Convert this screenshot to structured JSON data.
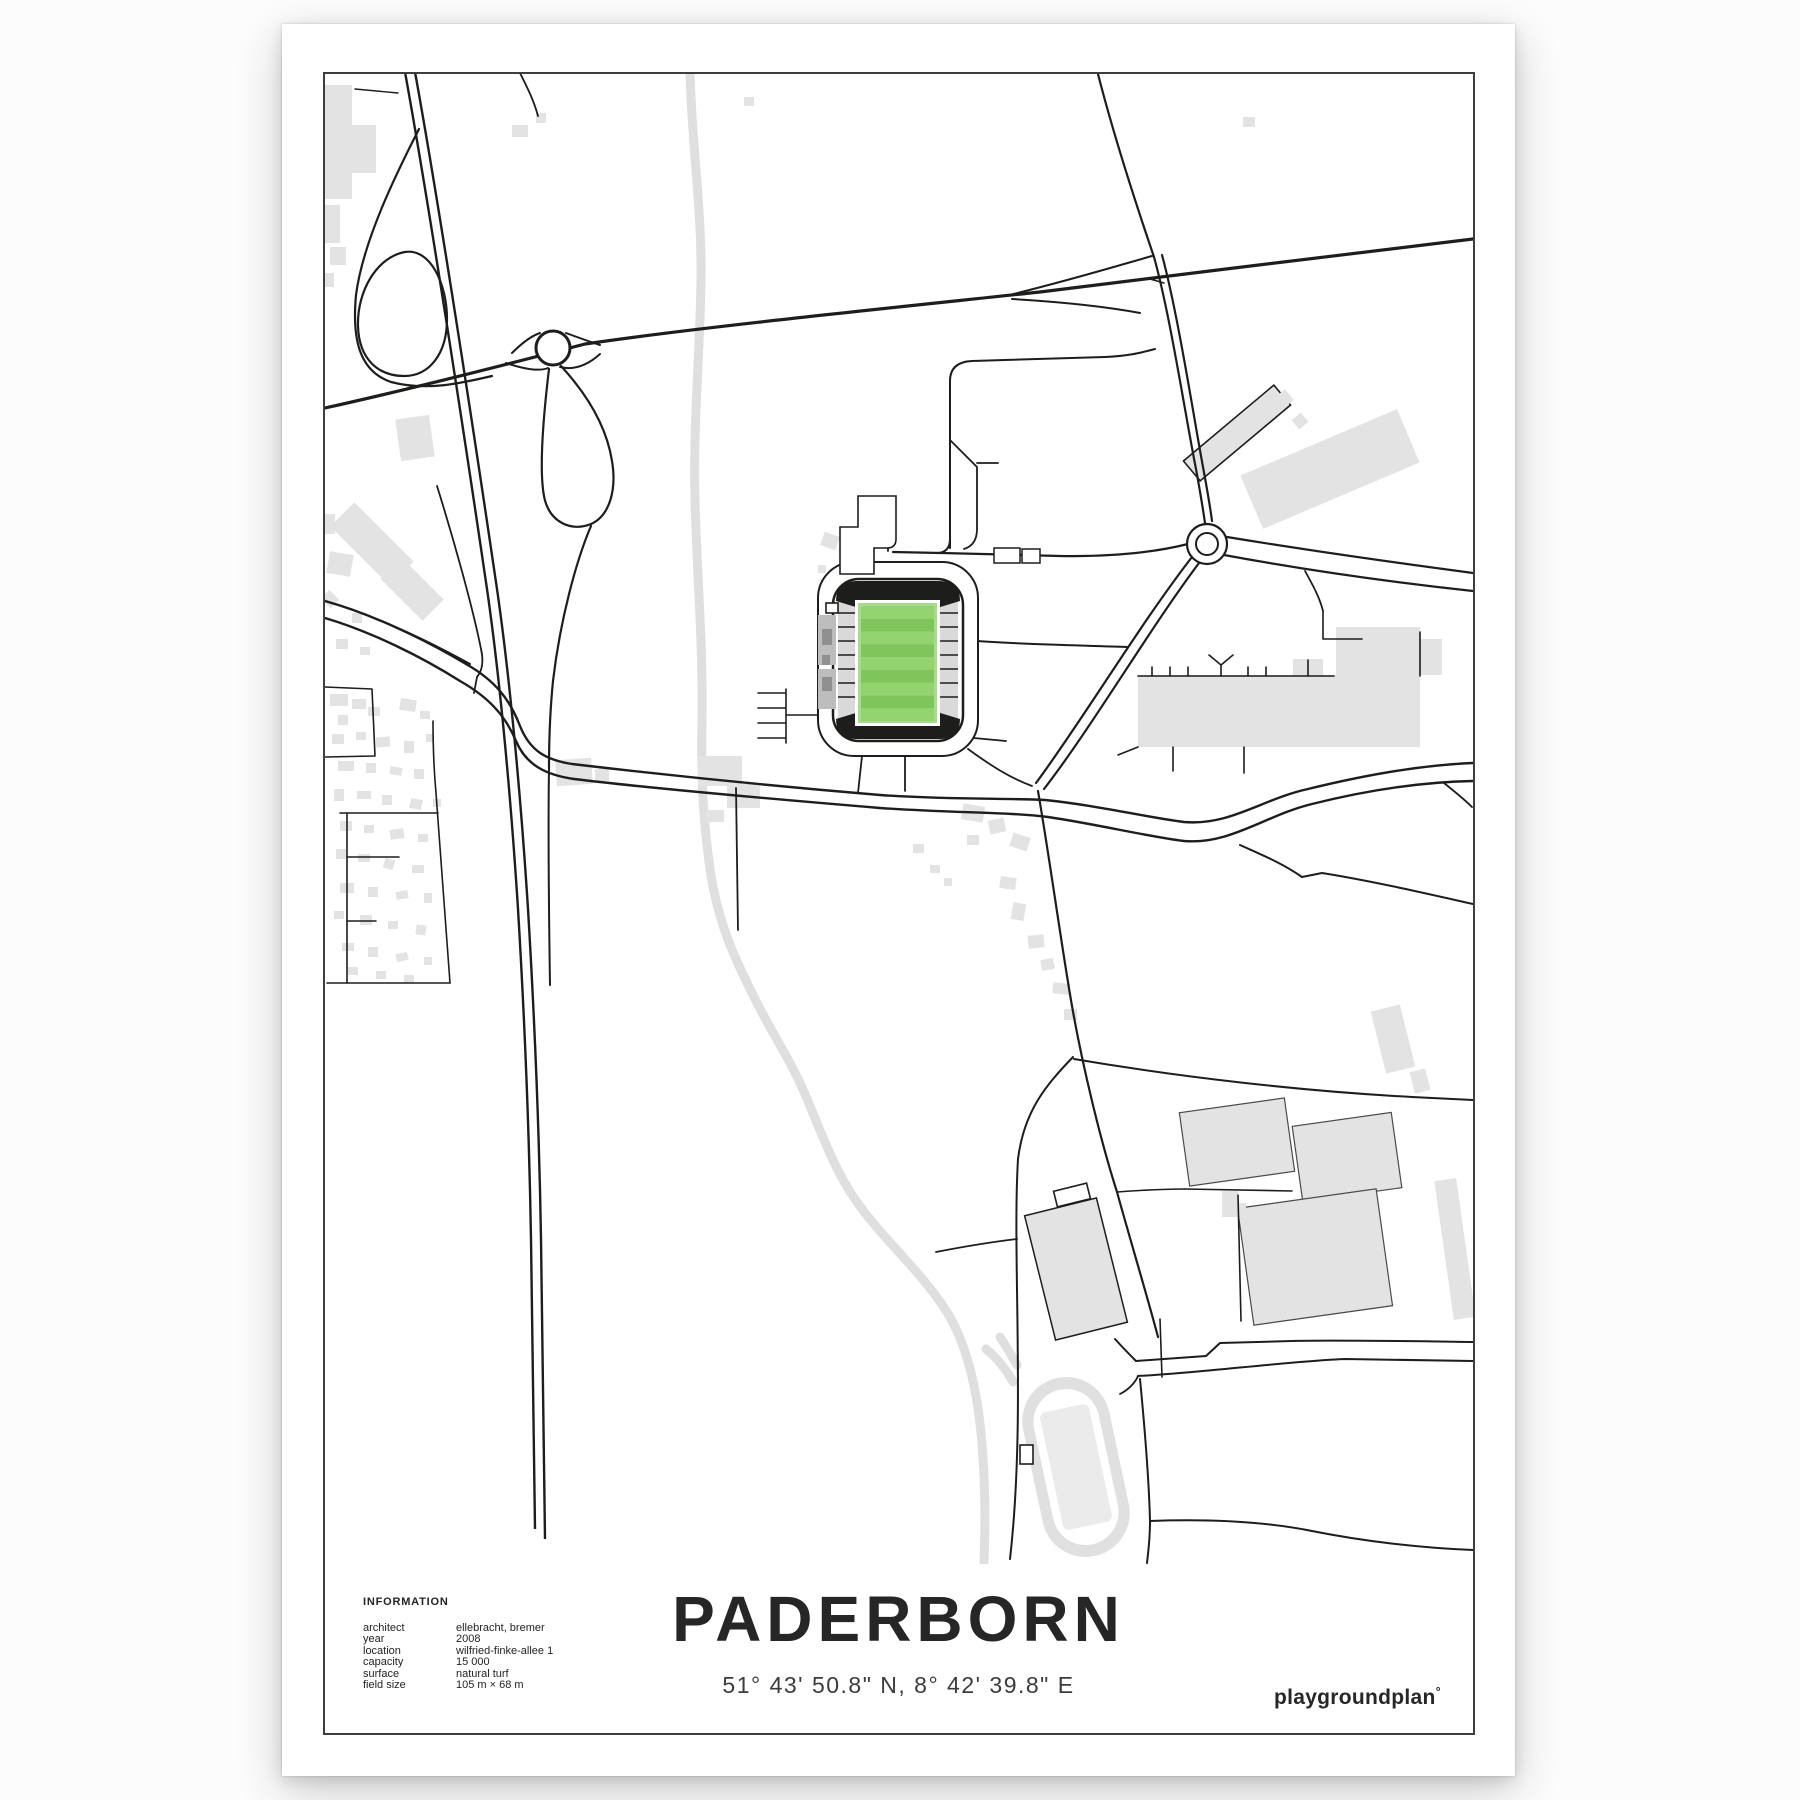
{
  "poster": {
    "title": "PADERBORN",
    "coordinates": "51° 43' 50.8\" N, 8° 42' 39.8\" E",
    "brand": "playgroundplan",
    "brand_mark": "°"
  },
  "information": {
    "header": "INFORMATION",
    "rows": [
      {
        "label": "architect",
        "value": "ellebracht, bremer"
      },
      {
        "label": "year",
        "value": "2008"
      },
      {
        "label": "location",
        "value": "wilfried-finke-allee 1"
      },
      {
        "label": "capacity",
        "value": "15 000"
      },
      {
        "label": "surface",
        "value": "natural turf"
      },
      {
        "label": "field size",
        "value": "105 m × 68 m"
      }
    ]
  },
  "map": {
    "features": {
      "stadium_pitch": "striped green football pitch",
      "river": "Pader river in light gray",
      "railway": "double-line railway running north-south",
      "roundabouts": 2
    },
    "colors": {
      "road": "#1d1d1b",
      "building": "#e3e3e3",
      "river": "#dfdfdf",
      "frame": "#3e3e3e",
      "pitch-dark": "#7fc55c",
      "pitch-light": "#93d471",
      "stand": "#d9d9d9",
      "annex": "#bdbdbd"
    }
  }
}
